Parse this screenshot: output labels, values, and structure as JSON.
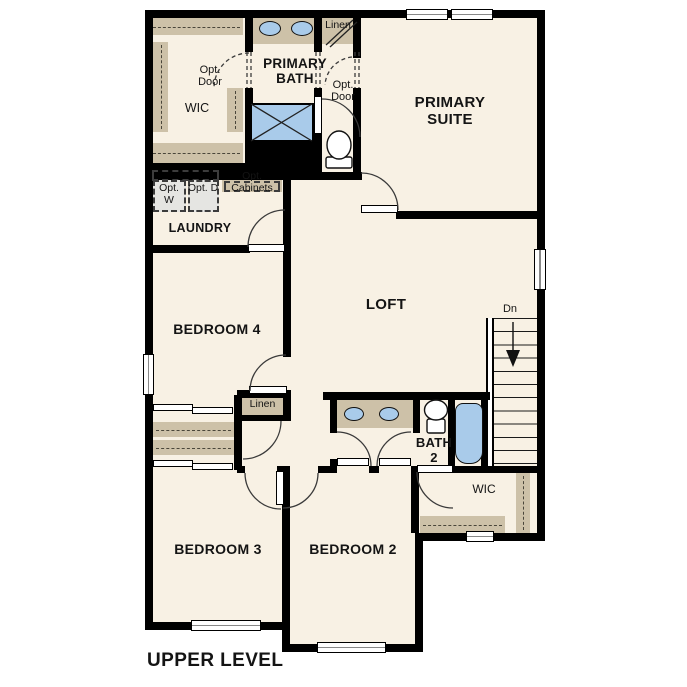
{
  "plan": {
    "title": "UPPER LEVEL",
    "rooms": {
      "primary_suite": "PRIMARY SUITE",
      "primary_bath": "PRIMARY BATH",
      "primary_wic": "WIC",
      "linen_upper": "Linen",
      "laundry": "LAUNDRY",
      "loft": "LOFT",
      "bedroom4": "BEDROOM 4",
      "linen_hall": "Linen",
      "bath2": "BATH 2",
      "bedroom3": "BEDROOM 3",
      "bedroom2": "BEDROOM 2",
      "bedroom2_wic": "WIC"
    },
    "annotations": {
      "opt_door_wic": "Opt. Door",
      "opt_door_suite": "Opt. Door",
      "opt_washer": "Opt. W",
      "opt_dryer": "Opt. D",
      "opt_cabinets": "Opt. Cabinets",
      "stairs_down": "Dn"
    },
    "colors": {
      "floor": "#f8f1e4",
      "wall": "#000000",
      "casework": "#cdc1a8",
      "fixture_blue": "#a9cbea",
      "appliance_gray": "#e5e5e2"
    }
  }
}
